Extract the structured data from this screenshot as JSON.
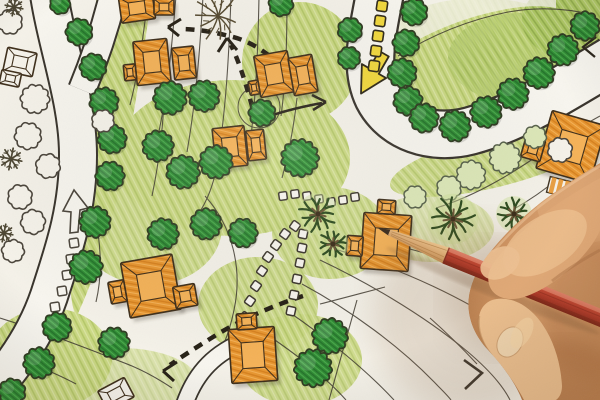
{
  "meta": {
    "description": "Photograph of a landscape architect's hand holding a red colored pencil over a hand-drawn housing site plan (colored pencil blueprint with orange houses, green trees, curving white roads and dashed circulation arrows)",
    "domain_guess": "Natural-Image"
  },
  "palette": {
    "paper": "#f5f2e9",
    "lawn": "#cbd983",
    "lawn_dark": "#b5cc6a",
    "tree_green": "#2f8c33",
    "tree_outline": "#3a342a",
    "house_orange": "#e8962f",
    "house_inner": "#f5b257",
    "road_white": "#f8f6ef",
    "ink": "#3a342a",
    "arrow_yellow": "#f2d83c",
    "pencil_red": "#b6402c",
    "pencil_wood": "#ddab72",
    "skin": "#d79c6a",
    "palm_green": "#2c4a1d"
  },
  "scene": {
    "green_trees": [
      [
        79,
        32,
        13
      ],
      [
        93,
        67,
        13
      ],
      [
        104,
        102,
        14
      ],
      [
        112,
        139,
        14
      ],
      [
        110,
        176,
        14
      ],
      [
        95,
        222,
        15
      ],
      [
        86,
        267,
        16
      ],
      [
        57,
        327,
        14
      ],
      [
        39,
        363,
        15
      ],
      [
        12,
        392,
        13
      ],
      [
        114,
        343,
        15
      ],
      [
        60,
        4,
        10
      ],
      [
        281,
        4,
        12
      ],
      [
        170,
        98,
        16
      ],
      [
        204,
        96,
        15
      ],
      [
        158,
        146,
        15
      ],
      [
        183,
        172,
        16
      ],
      [
        216,
        162,
        16
      ],
      [
        262,
        113,
        13
      ],
      [
        300,
        158,
        18
      ],
      [
        163,
        234,
        15
      ],
      [
        206,
        224,
        15
      ],
      [
        243,
        233,
        14
      ],
      [
        330,
        336,
        17
      ],
      [
        313,
        368,
        18
      ],
      [
        414,
        12,
        13
      ],
      [
        406,
        43,
        13
      ],
      [
        402,
        73,
        14
      ],
      [
        408,
        101,
        14
      ],
      [
        424,
        118,
        14
      ],
      [
        455,
        126,
        15
      ],
      [
        486,
        112,
        15
      ],
      [
        513,
        94,
        15
      ],
      [
        539,
        73,
        15
      ],
      [
        563,
        50,
        15
      ],
      [
        585,
        26,
        14
      ],
      [
        350,
        30,
        12
      ],
      [
        349,
        58,
        11
      ]
    ],
    "outline_trees": [
      [
        10,
        22,
        12
      ],
      [
        35,
        99,
        14
      ],
      [
        28,
        136,
        13
      ],
      [
        48,
        166,
        12
      ],
      [
        20,
        197,
        12
      ],
      [
        33,
        222,
        12
      ],
      [
        13,
        251,
        11
      ],
      [
        103,
        121,
        11
      ],
      [
        560,
        150,
        12
      ]
    ],
    "light_trees": [
      [
        449,
        188,
        12
      ],
      [
        471,
        175,
        14
      ],
      [
        505,
        158,
        15
      ],
      [
        415,
        197,
        11
      ],
      [
        535,
        137,
        11
      ]
    ],
    "palms": [
      [
        318,
        214,
        20
      ],
      [
        333,
        244,
        15
      ],
      [
        453,
        219,
        24
      ],
      [
        514,
        214,
        17
      ]
    ],
    "dark_shrubs": [
      [
        11,
        159,
        11
      ],
      [
        4,
        233,
        9
      ],
      [
        14,
        7,
        9
      ],
      [
        563,
        204,
        9
      ]
    ],
    "branch_tree": [
      218,
      16,
      27
    ],
    "houses": [
      {
        "x": 137,
        "y": 8,
        "rot": -8,
        "blocks": [
          [
            0,
            0,
            34,
            26
          ]
        ],
        "outline": false
      },
      {
        "x": 164,
        "y": 7,
        "rot": 0,
        "blocks": [
          [
            0,
            0,
            20,
            16
          ]
        ],
        "outline": false
      },
      {
        "x": 152,
        "y": 62,
        "rot": -6,
        "blocks": [
          [
            0,
            0,
            34,
            44
          ],
          [
            -23,
            8,
            12,
            16
          ]
        ],
        "outline": false
      },
      {
        "x": 184,
        "y": 63,
        "rot": -6,
        "blocks": [
          [
            0,
            0,
            22,
            32
          ]
        ],
        "outline": false
      },
      {
        "x": 274,
        "y": 74,
        "rot": -10,
        "blocks": [
          [
            0,
            0,
            34,
            42
          ],
          [
            -22,
            10,
            10,
            14
          ]
        ],
        "outline": false
      },
      {
        "x": 303,
        "y": 75,
        "rot": -10,
        "blocks": [
          [
            0,
            0,
            24,
            38
          ]
        ],
        "outline": false
      },
      {
        "x": 230,
        "y": 147,
        "rot": -6,
        "blocks": [
          [
            0,
            0,
            32,
            40
          ]
        ],
        "outline": false
      },
      {
        "x": 256,
        "y": 145,
        "rot": -6,
        "blocks": [
          [
            0,
            0,
            18,
            30
          ]
        ],
        "outline": false
      },
      {
        "x": 571,
        "y": 147,
        "rot": 16,
        "blocks": [
          [
            0,
            0,
            56,
            60
          ],
          [
            -36,
            12,
            20,
            22
          ]
        ],
        "outline": false
      },
      {
        "x": 151,
        "y": 286,
        "rot": -10,
        "blocks": [
          [
            0,
            0,
            52,
            56
          ],
          [
            32,
            16,
            22,
            22
          ],
          [
            -34,
            0,
            16,
            22
          ]
        ],
        "outline": false
      },
      {
        "x": 253,
        "y": 355,
        "rot": -4,
        "blocks": [
          [
            0,
            0,
            46,
            54
          ],
          [
            -4,
            -34,
            20,
            16
          ]
        ],
        "outline": false
      },
      {
        "x": 386,
        "y": 242,
        "rot": 4,
        "blocks": [
          [
            0,
            0,
            48,
            56
          ],
          [
            -2,
            -35,
            18,
            14
          ],
          [
            -31,
            6,
            16,
            20
          ]
        ],
        "outline": false
      },
      {
        "x": 20,
        "y": 62,
        "rot": 12,
        "blocks": [
          [
            0,
            0,
            30,
            24
          ],
          [
            -6,
            18,
            20,
            14
          ]
        ],
        "outline": true
      },
      {
        "x": 116,
        "y": 394,
        "rot": -28,
        "blocks": [
          [
            0,
            0,
            30,
            22
          ]
        ],
        "outline": true
      }
    ],
    "yellow_dashes": {
      "size": 10.5,
      "rot": 8,
      "points": [
        [
          382,
          6
        ],
        [
          380,
          21
        ],
        [
          378,
          36
        ],
        [
          376,
          51
        ],
        [
          374,
          66
        ]
      ]
    },
    "dotted_paths": [
      {
        "size": 8.5,
        "rot": -55,
        "points": [
          [
            239,
            333
          ],
          [
            245,
            317
          ],
          [
            250,
            301
          ],
          [
            256,
            286
          ],
          [
            262,
            271
          ],
          [
            268,
            257
          ],
          [
            276,
            245
          ],
          [
            285,
            234
          ],
          [
            295,
            226
          ]
        ]
      },
      {
        "size": 8.5,
        "rot": -78,
        "points": [
          [
            291,
            311
          ],
          [
            294,
            295
          ],
          [
            297,
            279
          ],
          [
            300,
            263
          ],
          [
            302,
            248
          ],
          [
            303,
            234
          ]
        ]
      },
      {
        "size": 8,
        "rot": -8,
        "points": [
          [
            283,
            196
          ],
          [
            295,
            194
          ],
          [
            307,
            196
          ],
          [
            319,
            199
          ],
          [
            331,
            202
          ],
          [
            343,
            200
          ],
          [
            355,
            197
          ]
        ]
      }
    ],
    "road_squares": {
      "size": 9,
      "rot": -8,
      "points": [
        [
          74,
          243
        ],
        [
          71,
          259
        ],
        [
          67,
          275
        ],
        [
          62,
          291
        ],
        [
          55,
          307
        ]
      ]
    }
  }
}
